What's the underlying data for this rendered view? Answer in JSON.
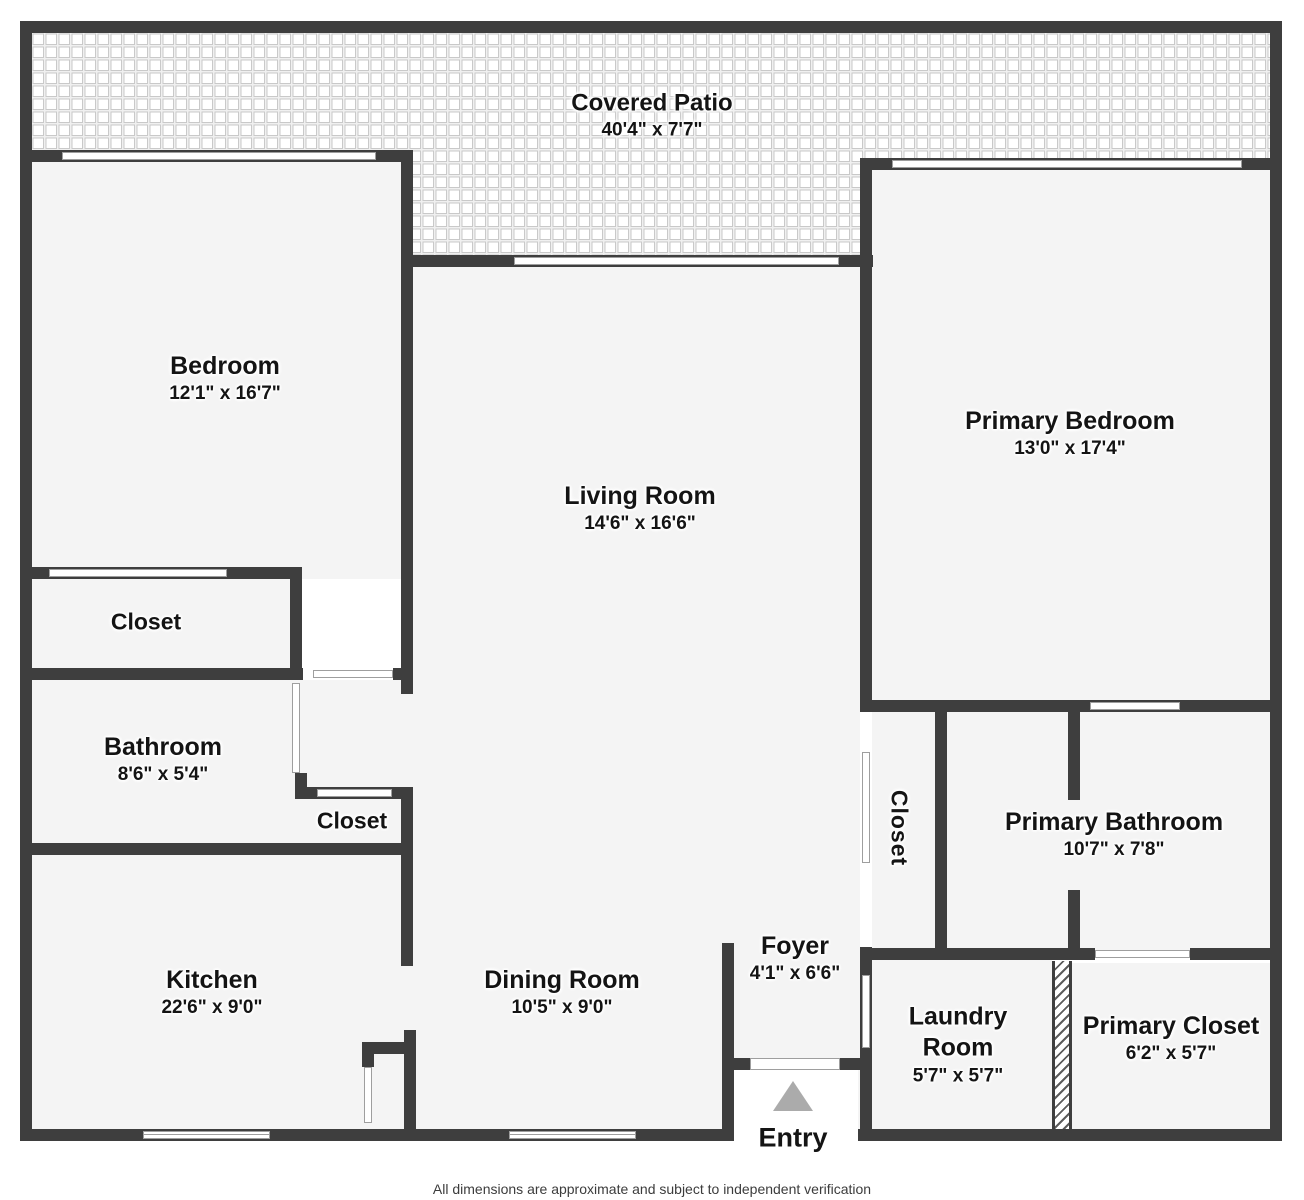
{
  "patio": {
    "name": "Covered Patio",
    "dims": "40'4\" x 7'7\""
  },
  "rooms": [
    {
      "id": "bedroom",
      "name": "Bedroom",
      "dims": "12'1\" x 16'7\""
    },
    {
      "id": "living-room",
      "name": "Living Room",
      "dims": "14'6\" x 16'6\""
    },
    {
      "id": "primary-bedroom",
      "name": "Primary Bedroom",
      "dims": "13'0\" x 17'4\""
    },
    {
      "id": "bedroom-closet",
      "name": "Closet",
      "dims": ""
    },
    {
      "id": "bathroom",
      "name": "Bathroom",
      "dims": "8'6\" x 5'4\""
    },
    {
      "id": "hall-closet",
      "name": "Closet",
      "dims": ""
    },
    {
      "id": "kitchen",
      "name": "Kitchen",
      "dims": "22'6\" x 9'0\""
    },
    {
      "id": "dining-room",
      "name": "Dining Room",
      "dims": "10'5\" x 9'0\""
    },
    {
      "id": "foyer",
      "name": "Foyer",
      "dims": "4'1\" x 6'6\""
    },
    {
      "id": "walk-in-closet",
      "name": "Closet",
      "dims": ""
    },
    {
      "id": "primary-bathroom",
      "name": "Primary Bathroom",
      "dims": "10'7\" x 7'8\""
    },
    {
      "id": "laundry-room",
      "name": "Laundry Room",
      "dims": "5'7\" x 5'7\""
    },
    {
      "id": "primary-closet",
      "name": "Primary Closet",
      "dims": "6'2\" x 5'7\""
    }
  ],
  "entry": {
    "label": "Entry"
  },
  "footer": {
    "disclaimer": "All dimensions are approximate and subject to independent verification"
  },
  "colors": {
    "wall": "#3e3e3e",
    "floor": "#f4f4f4",
    "door_outline": "#9e9e9e",
    "entry_arrow": "#ababab",
    "patio_tile_line": "#c9c9c9"
  }
}
